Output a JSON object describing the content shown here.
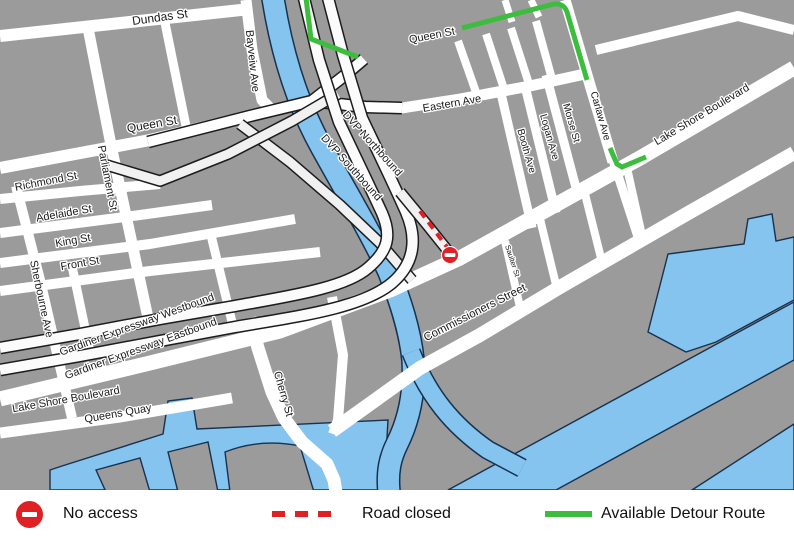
{
  "colors": {
    "background": "#9b9b9b",
    "road": "#ffffff",
    "ramp": "#f1f1f1",
    "casing": "#1c1c1c",
    "water": "#85c4ef",
    "water_edge": "#16324f",
    "detour_green": "#3dbd3d",
    "closure_red": "#df2126",
    "label": "#1a1a1a",
    "legend_bg": "#ffffff",
    "legend_text": "#111111"
  },
  "map": {
    "street_labels": [
      "Dundas St",
      "Queen St",
      "Richmond St",
      "Adelaide St",
      "King St",
      "Front St",
      "Parliament St",
      "Sherbourne Ave",
      "Bayveiw Ave",
      "Queen St",
      "Eastern Ave",
      "DVP Northbound",
      "DVP Southbound",
      "Booth Ave",
      "Logan Ave",
      "Morse St",
      "Carlaw Ave",
      "Lake Shore Boulevard",
      "Gardiner Expressway Westbound",
      "Gardiner Expressway Eastbound",
      "Lake Shore Boulevard",
      "Queens Quay",
      "Cherry St",
      "Saulter St",
      "Commissioners Street"
    ]
  },
  "legend": {
    "items": [
      {
        "icon": "no-entry-icon",
        "label": "No access"
      },
      {
        "icon": "dashed-line-icon",
        "label": "Road closed"
      },
      {
        "icon": "solid-line-icon",
        "label": "Available Detour Route"
      }
    ]
  }
}
